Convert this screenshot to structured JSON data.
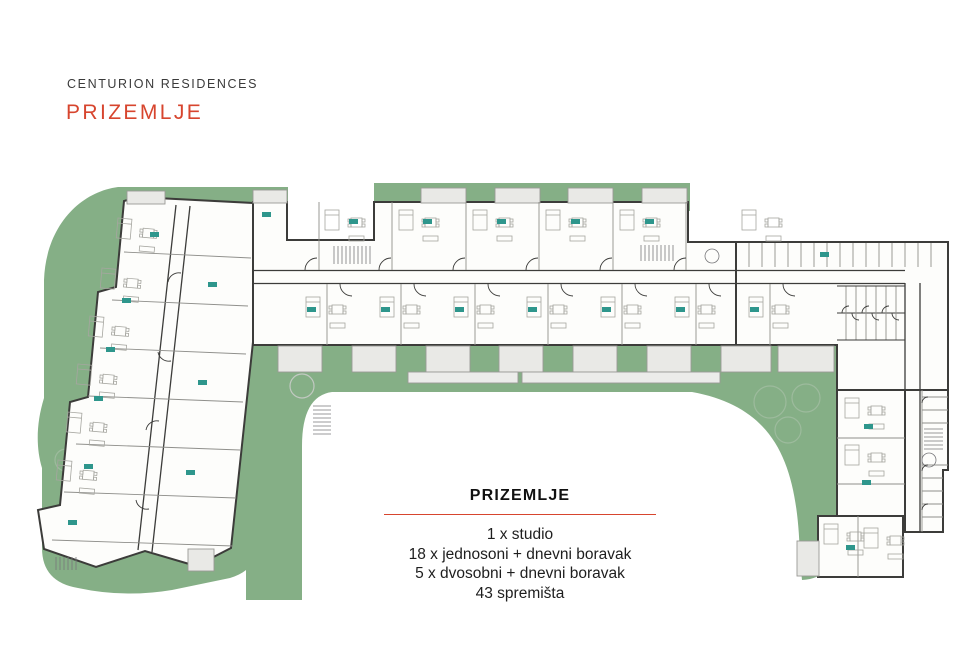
{
  "header": {
    "project": "CENTURION RESIDENCES",
    "floor_title": "PRIZEMLJE"
  },
  "legend": {
    "title": "PRIZEMLJE",
    "items": [
      "1 x studio",
      "18 x jednosoni + dnevni boravak",
      "5 x dvosobni + dnevni boravak",
      "43 spremišta"
    ]
  },
  "plan": {
    "type": "architectural-floor-plan",
    "floor_label": "PRIZEMLJE",
    "unit_counts": {
      "studio": 1,
      "jednosoni_dnevni_boravak": 18,
      "dvosobni_dnevni_boravak": 5,
      "spremista": 43
    }
  },
  "colors": {
    "accent_red": "#d7452e",
    "landscape_green": "#85af86",
    "unit_label_teal": "#2e968c",
    "wall_dark": "#3c3c3a",
    "terrace_gray": "#e9e9e6"
  }
}
